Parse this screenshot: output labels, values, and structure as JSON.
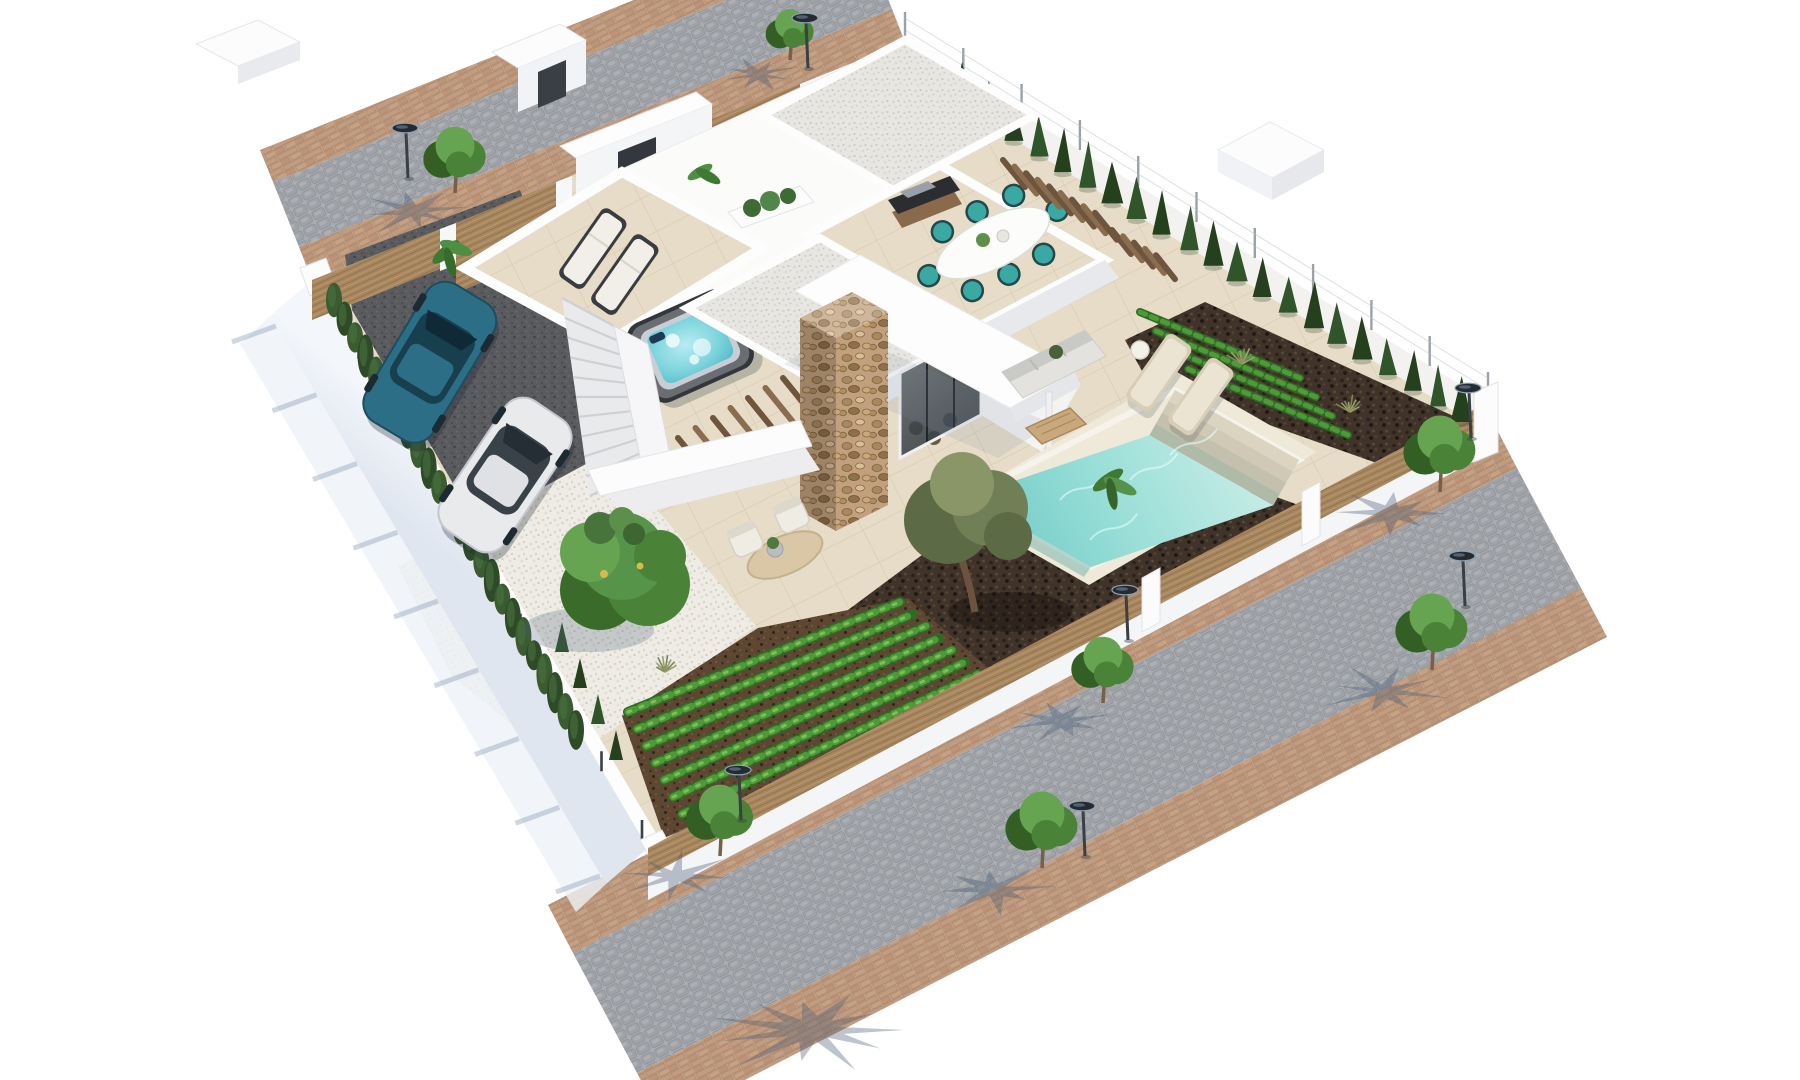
{
  "scene": {
    "title": "aerial-3d-render-modern-villa-with-pool",
    "view": "isometric-aerial",
    "setting": "residential-corner-plot-with-two-streets",
    "palette": {
      "background": "#ffffff",
      "cobble_base": "#a9adb2",
      "cobble_stone": "#9aa0a6",
      "brick_base": "#c9a58a",
      "brick_stone": "#c19c80",
      "brick_line": "#a9876c",
      "tile_base": "#e6dcc7",
      "tile_line": "#c7b594",
      "gravel_white": "#eeece5",
      "gravel_roof": "#e8e6e2",
      "driveway": "#5a5b5f",
      "mulch": "#40332a",
      "soil": "#5d4733",
      "crop_dark": "#2f6b25",
      "crop_light": "#4f9a38",
      "crop_bright": "#7cbf57",
      "cypress_dark": "#24401d",
      "cypress_mid": "#30552a",
      "hedge_green": "#2e4b27",
      "tree_green": "#4a8338",
      "tree_green_light": "#67a452",
      "tree_green_dark": "#335f24",
      "olive_green": "#707f55",
      "olive_dark": "#5c6b45",
      "wood_fence": "#a8875f",
      "wood_dark": "#8a6c4e",
      "wall_white": "#fdfdfd",
      "wall_shade": "#ededf0",
      "wall_blue_shade": "#dfe6f0",
      "shadow_blue": "rgba(70,90,115,0.42)",
      "glass_dark": "#39444d",
      "pool_shallow": "#c4ebe5",
      "pool_deep": "#72ccc6",
      "pool_step": "#d8d1be",
      "hot_tub_water": "#7fd5dd",
      "chair_teal": "#3aa8a3",
      "car_blue": "#2b6e85",
      "car_blue_dark": "#173f4e",
      "car_white": "#e9eaec",
      "car_white_dark": "#cfd3d8",
      "stone_base": "#c2a07e",
      "lounger_cushion": "#f1efe8",
      "lounger_frame": "#3a3c40",
      "rug_tan": "#d9c7a5",
      "sofa_gray": "#e3e2de",
      "rattan_tan": "#c9a87c",
      "metal_dark": "#262b31",
      "lamp_rim": "#8fa3b5"
    },
    "objects": {
      "villa": {
        "style": "modern-white-flat-roof",
        "levels": 2,
        "roof_finish": "white-gravel",
        "feature_wall": "natural-stone-clad-chimney",
        "facade": "floor-to-ceiling-glass"
      },
      "pool": {
        "shape": "rectangular",
        "steps": 4,
        "loungers": 2,
        "side_table": 1
      },
      "roof_terrace": {
        "sun_loungers": 2,
        "hot_tub": 1,
        "planter": 1
      },
      "dining_terrace": {
        "table": "white-oval",
        "chairs": 8,
        "chair_color": "teal",
        "bbq_grill": 1,
        "louver_benches": 2
      },
      "cars": [
        {
          "name": "car-blue-suv",
          "color": "teal-blue"
        },
        {
          "name": "car-white-suv",
          "color": "white-silver"
        }
      ],
      "garden": {
        "vegetable_rows": 8,
        "ne_crop_rows": 4,
        "olive_tree": 1,
        "large_leafy_tree": 1,
        "white_gravel_bed": 1,
        "mulch_beds": 2,
        "lounge_nook_chairs": 2,
        "jute_rug": 1
      },
      "street_lamps": 7,
      "street_trees": 7,
      "cypress_fence_row": 22,
      "hedge_cypresses": 24,
      "small_cypresses": 4,
      "fences": [
        "wood-slat-front-fence",
        "wire-mesh-side-fence",
        "wood-slat-street-fence",
        "white-retaining-wall"
      ],
      "outdoor_sofa": {
        "cushions": 3,
        "coffee_table": "wood-slat"
      }
    },
    "layout": {
      "plot": [
        [
          905,
          42
        ],
        [
          1488,
          402
        ],
        [
          648,
          848
        ],
        [
          312,
          280
        ]
      ],
      "lamps": [
        [
          805,
          18
        ],
        [
          405,
          128
        ],
        [
          1468,
          388
        ],
        [
          1462,
          556
        ],
        [
          1125,
          590
        ],
        [
          1082,
          806
        ],
        [
          738,
          770
        ]
      ],
      "street_trees": [
        [
          790,
          60,
          20
        ],
        [
          455,
          193,
          26
        ],
        [
          1440,
          492,
          30
        ],
        [
          1432,
          670,
          30
        ],
        [
          1103,
          703,
          26
        ],
        [
          1042,
          868,
          30
        ],
        [
          720,
          856,
          28
        ]
      ],
      "palm_shadows": [
        [
          812,
          1030,
          95
        ]
      ],
      "cypress_row": {
        "a": [
          938,
          80
        ],
        "b": [
          1462,
          408
        ],
        "count": 22
      },
      "hedge": {
        "a": [
          334,
          300
        ],
        "b": [
          576,
          730
        ],
        "count": 24
      },
      "small_cypresses": [
        [
          562,
          652
        ],
        [
          580,
          688
        ],
        [
          598,
          724
        ],
        [
          616,
          760
        ]
      ],
      "grass_tufts": [
        [
          665,
          672
        ],
        [
          1242,
          364
        ],
        [
          1350,
          412
        ]
      ],
      "veg_rows": {
        "count": 8,
        "x0": 628,
        "y0": 712,
        "x1": 900,
        "y1": 602,
        "dx": 9,
        "dy": 17,
        "dx1": 13,
        "dy1": 12
      },
      "ne_rows": {
        "count": 4,
        "x0": 1140,
        "y0": 312,
        "x1": 1300,
        "y1": 378,
        "dx": 16,
        "dy": 19
      },
      "stairs": {
        "tl": [
          562,
          298
        ],
        "tr": [
          614,
          326
        ],
        "bl": [
          590,
          496
        ],
        "br": [
          642,
          468
        ],
        "treads": 11
      },
      "ne_fence": {
        "a": [
          905,
          42
        ],
        "b": [
          1488,
          402
        ],
        "posts": 11
      },
      "sw_wall": {
        "a": [
          318,
          290
        ],
        "b": [
          642,
          840
        ],
        "posts": 9
      },
      "dining_table": {
        "cx": 993,
        "cy": 243,
        "rot": -27,
        "chairs": 8
      },
      "louvers": [
        {
          "x": 1003,
          "y": 160,
          "sx": 11.5,
          "sy": 6.6,
          "n": 9,
          "dx": 22,
          "dy": 27
        },
        {
          "x": 1112,
          "y": 230,
          "sx": 11,
          "sy": 6.3,
          "n": 5,
          "dx": 19,
          "dy": 24
        },
        {
          "x": 712,
          "y": 480,
          "sx": 17.5,
          "sy": -10,
          "n": 8,
          "dx": -34,
          "dy": -42
        }
      ],
      "caustics": [
        [
          1060,
          500
        ],
        [
          1130,
          480
        ],
        [
          1090,
          540
        ],
        [
          1170,
          455
        ]
      ]
    }
  }
}
